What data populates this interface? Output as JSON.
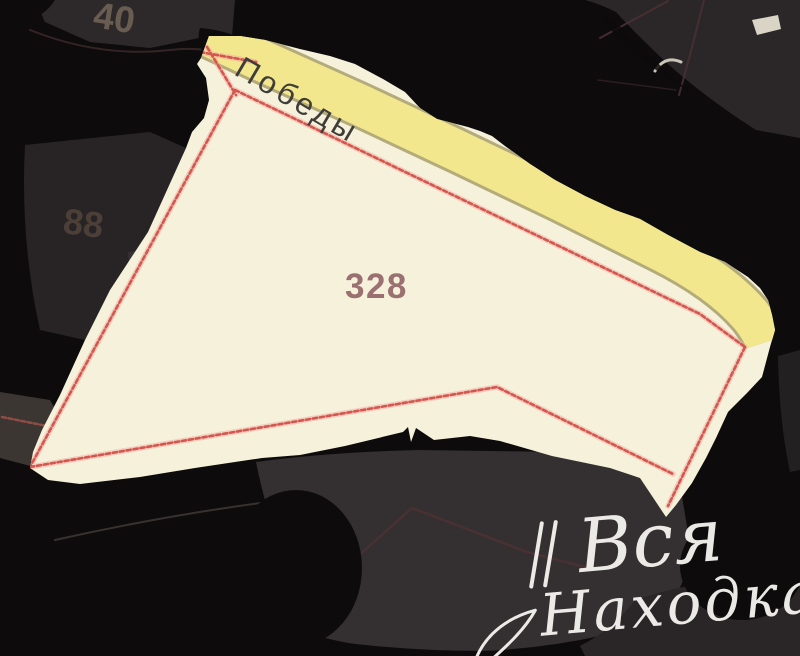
{
  "map": {
    "parcel": {
      "number": "328"
    },
    "street": {
      "name": "Победы"
    },
    "faint_labels": {
      "house_number_top": "40",
      "house_number_left": "88"
    },
    "watermark": {
      "line1": "Вся",
      "line2": "Находка"
    },
    "colors": {
      "background_black": "#0d0b0c",
      "background_gray": "#2d292a",
      "parcel_fill": "#f5f1db",
      "road_fill": "#f3e78e",
      "road_casing": "#b4ab7b",
      "boundary_red": "#d4574f",
      "boundary_halo": "#f2aba1",
      "parcel_number_color": "#9b7070",
      "street_label_color": "#3e3d37",
      "house_number_top_color": "#6f6355",
      "house_number_left_color": "#4f4339",
      "faint_line_maroon": "#4a3034",
      "watermark_color": "#f4f2ee"
    }
  }
}
